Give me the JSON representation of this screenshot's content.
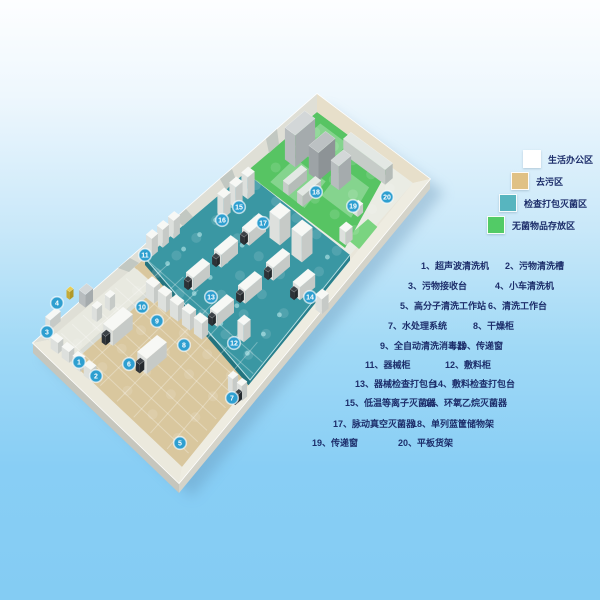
{
  "legend": {
    "items": [
      {
        "label": "生活办公区",
        "color": "#ffffff"
      },
      {
        "label": "去污区",
        "color": "#e0c185"
      },
      {
        "label": "检查打包灭菌区",
        "color": "#57b5bf"
      },
      {
        "label": "无菌物品存放区",
        "color": "#52cb66"
      }
    ]
  },
  "equipment_list": {
    "items": [
      "1、超声波清洗机",
      "2、污物清洗槽",
      "3、污物接收台",
      "4、小车清洗机",
      "5、高分子清洗工作站",
      "6、清洗工作台",
      "7、水处理系统",
      "8、干燥柜",
      "9、全自动清洗消毒器",
      "10、传递窗",
      "11、器械柜",
      "12、敷料柜",
      "13、器械检查打包台",
      "14、敷料检查打包台",
      "15、低温等离子灭菌器",
      "16、环氧乙烷灭菌器",
      "17、脉动真空灭菌器",
      "18、单列蓝筐储物架",
      "19、传递窗",
      "20、平板货架"
    ]
  },
  "plan_markers": [
    {
      "n": "1",
      "x": 79,
      "y": 362
    },
    {
      "n": "2",
      "x": 96,
      "y": 376
    },
    {
      "n": "3",
      "x": 47,
      "y": 332
    },
    {
      "n": "4",
      "x": 57,
      "y": 303
    },
    {
      "n": "5",
      "x": 180,
      "y": 443
    },
    {
      "n": "6",
      "x": 129,
      "y": 364
    },
    {
      "n": "7",
      "x": 232,
      "y": 398
    },
    {
      "n": "8",
      "x": 184,
      "y": 345
    },
    {
      "n": "9",
      "x": 157,
      "y": 321
    },
    {
      "n": "10",
      "x": 142,
      "y": 307
    },
    {
      "n": "11",
      "x": 145,
      "y": 255
    },
    {
      "n": "12",
      "x": 234,
      "y": 343
    },
    {
      "n": "13",
      "x": 211,
      "y": 297
    },
    {
      "n": "14",
      "x": 310,
      "y": 297
    },
    {
      "n": "15",
      "x": 239,
      "y": 207
    },
    {
      "n": "16",
      "x": 222,
      "y": 220
    },
    {
      "n": "17",
      "x": 263,
      "y": 223
    },
    {
      "n": "18",
      "x": 316,
      "y": 192
    },
    {
      "n": "19",
      "x": 353,
      "y": 206
    },
    {
      "n": "20",
      "x": 387,
      "y": 197
    }
  ],
  "colors": {
    "marker": "#2e9fd0",
    "list_text": "#1d2e6b",
    "floor_tan": "#d9c79e",
    "floor_teal": "#3a97a3",
    "floor_green": "#57c463",
    "floor_white": "#eaece4",
    "wall": "#f0eee5"
  }
}
